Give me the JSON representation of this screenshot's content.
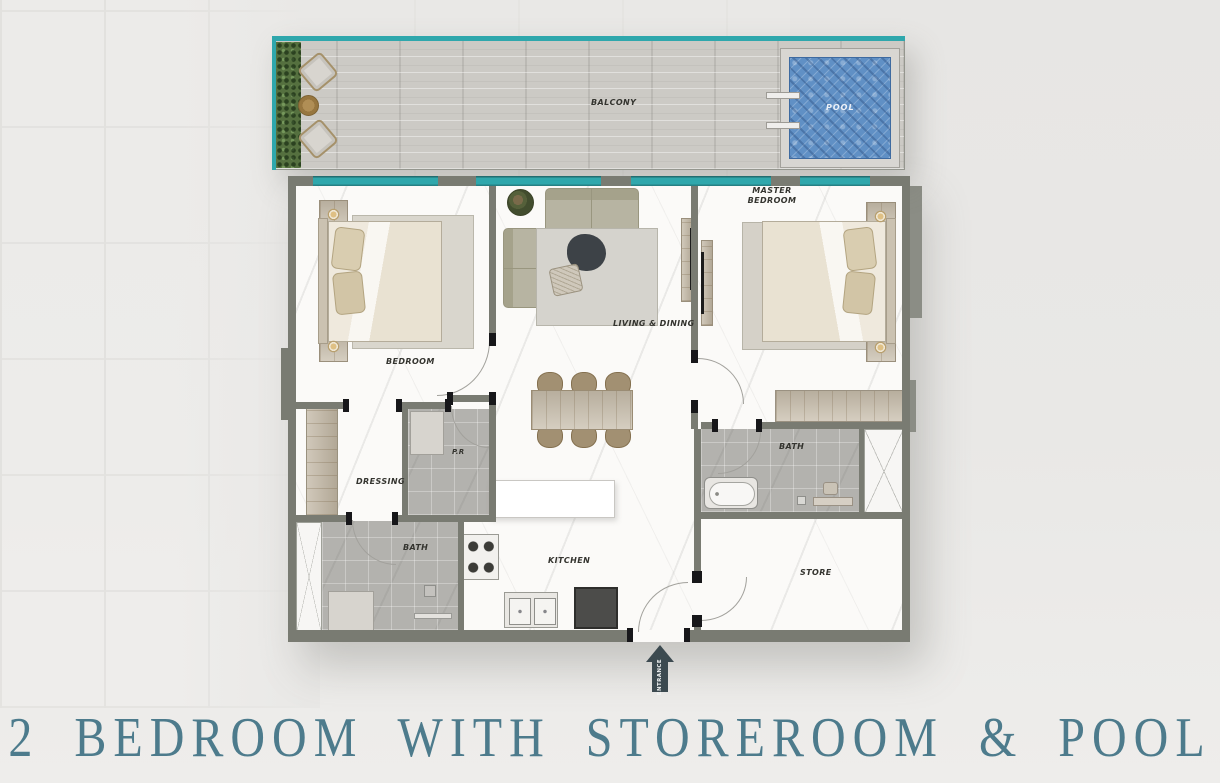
{
  "title": {
    "text": "2 BEDROOM WITH STOREROOM & POOL"
  },
  "plan": {
    "balcony_label": "BALCONY",
    "pool_label": "POOL",
    "master_bedroom_label": "MASTER BEDROOM",
    "bedroom_label": "BEDROOM",
    "living_dining_label": "LIVING & DINING",
    "dressing_label": "DRESSING",
    "powder_room_label": "P.R",
    "bath_left_label": "BATH",
    "bath_master_label": "BATH",
    "kitchen_label": "KITCHEN",
    "store_label": "STORE",
    "entrance_label": "ENTRANCE"
  },
  "colors": {
    "title_teal": "#4d7b8c",
    "window_teal": "#2fa7ac",
    "wall_gray": "#797b72",
    "pool_blue": "#6090c5",
    "arrow_slate": "#3c4a50"
  }
}
